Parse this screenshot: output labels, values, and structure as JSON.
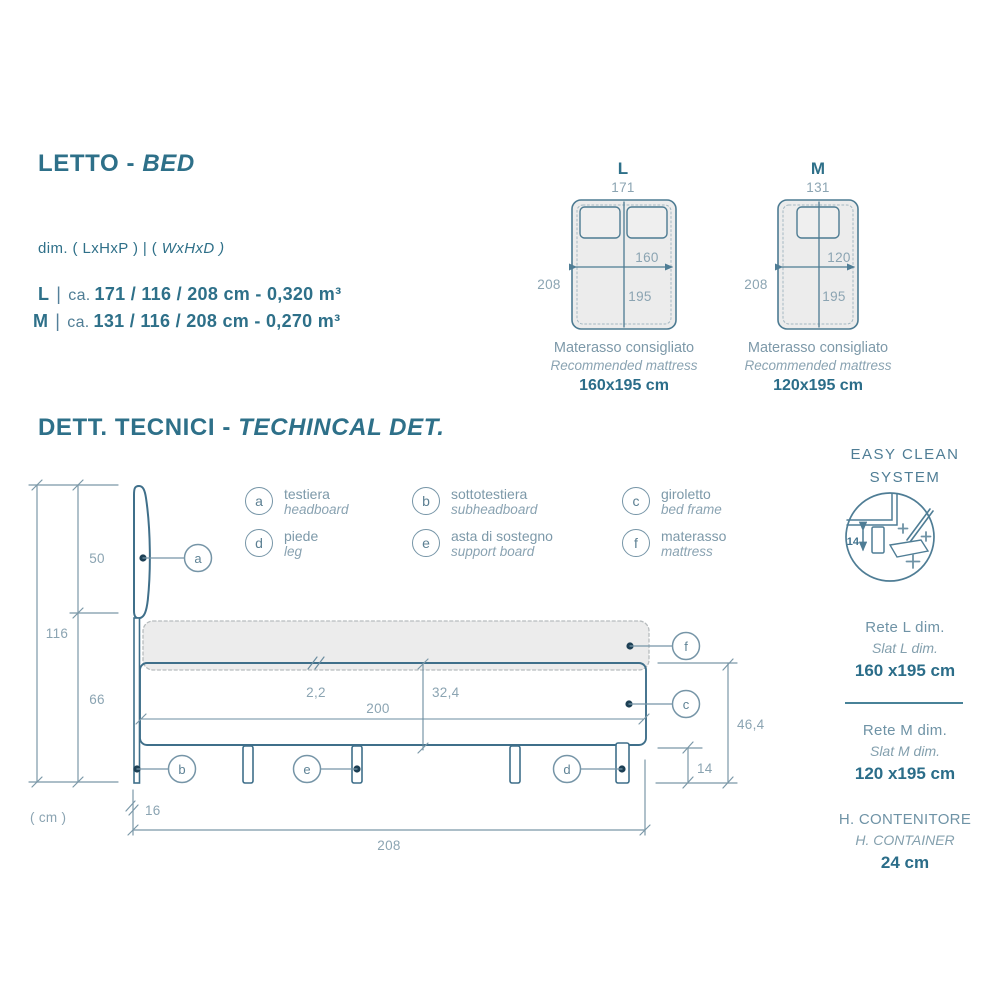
{
  "palette": {
    "heading_teal": "#2e7089",
    "line_steel": "#4d7b92",
    "leader_gray": "#7695a7",
    "dim_label": "#8ba4b2",
    "dot_navy": "#1d4055",
    "mattress_fill": "#ececec",
    "mattress_stroke": "#b7bcbe",
    "value_teal": "#2b6d89"
  },
  "letto": {
    "title": "LETTO -",
    "title_accent": "BED",
    "dims_label": "dim. ( LxHxP ) | (",
    "dims_label_accent": "WxHxD )",
    "rows": [
      {
        "key": "L",
        "approx": "ca.",
        "value": "171 / 116 / 208 cm - 0,320 m³"
      },
      {
        "key": "M",
        "approx": "ca.",
        "value": "131 / 116 / 208 cm - 0,270 m³"
      }
    ]
  },
  "top_views": {
    "l": {
      "label": "L",
      "width": "171",
      "depth": "208",
      "mattress_width": "160",
      "mattress_length": "195",
      "caption_it": "Materasso consigliato",
      "caption_en": "Recommended mattress",
      "size": "160x195 cm"
    },
    "m": {
      "label": "M",
      "width": "131",
      "depth": "208",
      "mattress_width": "120",
      "mattress_length": "195",
      "caption_it": "Materasso consigliato",
      "caption_en": "Recommended mattress",
      "size": "120x195 cm"
    }
  },
  "tech": {
    "title": "DETT. TECNICI -",
    "title_accent": "TECHINCAL DET.",
    "legend": [
      {
        "key": "a",
        "it": "testiera",
        "en": "headboard"
      },
      {
        "key": "b",
        "it": "sottotestiera",
        "en": "subheadboard"
      },
      {
        "key": "c",
        "it": "giroletto",
        "en": "bed frame"
      },
      {
        "key": "d",
        "it": "piede",
        "en": "leg"
      },
      {
        "key": "e",
        "it": "asta di sostegno",
        "en": "support board"
      },
      {
        "key": "f",
        "it": "materasso",
        "en": "mattress"
      }
    ],
    "dims": {
      "total_height": "116",
      "headboard_height": "50",
      "base_height": "66",
      "unit": "( cm )",
      "frame_thickness": "2,2",
      "inner_length": "200",
      "frame_height": "32,4",
      "box_height": "46,4",
      "leg_height": "14",
      "headboard_depth": "16",
      "total_depth": "208"
    }
  },
  "easy_clean": {
    "title_line1": "EASY CLEAN",
    "title_line2": "SYSTEM",
    "leg_height": "14"
  },
  "side_panel": {
    "sections": [
      {
        "title": "Rete L dim.",
        "subtitle": "Slat L dim.",
        "value": "160 x195 cm"
      },
      {
        "title": "Rete M dim.",
        "subtitle": "Slat M dim.",
        "value": "120 x195 cm"
      },
      {
        "title": "H. CONTENITORE",
        "subtitle": "H. CONTAINER",
        "value": "24 cm"
      }
    ]
  }
}
